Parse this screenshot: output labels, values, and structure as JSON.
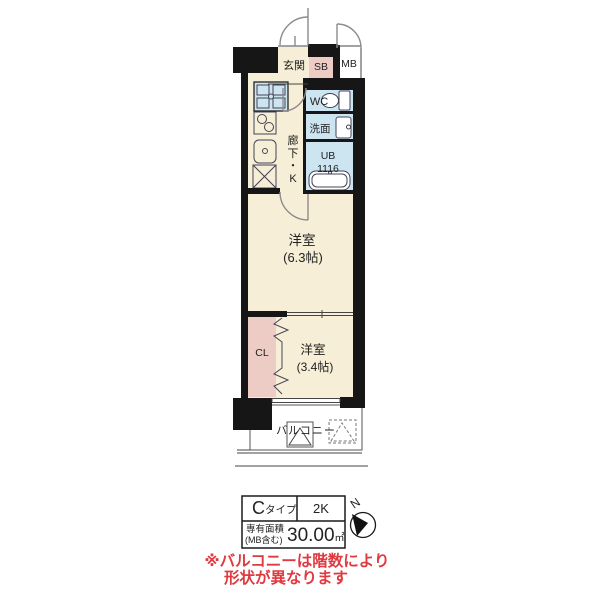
{
  "plan": {
    "labels": {
      "genkan": "玄関",
      "sb": "SB",
      "mb": "MB",
      "wc": "WC",
      "senmen": "洗面",
      "ub": "UB",
      "ub_size": "1116",
      "hall_k": [
        "廊",
        "下",
        "・",
        "K"
      ],
      "room1_name": "洋室",
      "room1_size": "(6.3帖)",
      "room2_name": "洋室",
      "room2_size": "(3.4帖)",
      "closet": "CL",
      "balcony": "バルコニー"
    },
    "colors": {
      "floor_cream": "#f6eed6",
      "wet_area_blue": "#cde4f1",
      "closet_pink": "#edccc6",
      "wall_black": "#161616",
      "door_arc_gray": "#8c8c8c",
      "note_red": "#e0393f"
    }
  },
  "info_table": {
    "type_main": "C",
    "type_sub": "タイプ",
    "layout": "2K",
    "area_label_line1": "専有面積",
    "area_label_line2": "(MB含む)",
    "area_value": "30.00",
    "area_unit": "㎡"
  },
  "compass": {
    "north": "N"
  },
  "note": {
    "line1": "※バルコニーは階数により",
    "line2": "形状が異なります"
  }
}
